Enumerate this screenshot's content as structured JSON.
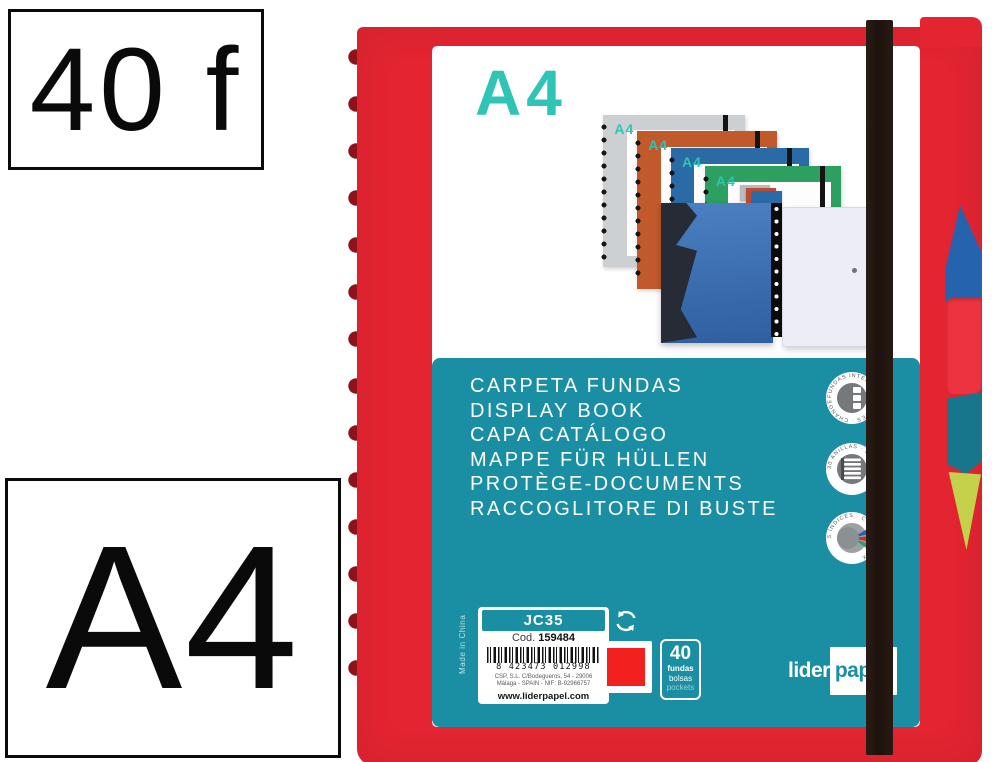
{
  "overlays": {
    "sheets": "40 f",
    "format": "A4"
  },
  "product": {
    "cover_format": "A4",
    "mini_cover_label": "A4",
    "banner_lines": [
      "CARPETA FUNDAS",
      "DISPLAY BOOK",
      "CAPA CATÁLOGO",
      "MAPPE FÜR HÜLLEN",
      "PROTÈGE-DOCUMENTS",
      "RACCOGLITORE DI BUSTE"
    ],
    "badges": [
      {
        "label": "FUNDAS INTERCAMBIABLES · CHANGEABLE POCKETS"
      },
      {
        "label": "30 ANILLAS · 30 RINGS"
      },
      {
        "label": "5 ÍNDICES · COLOR INDEX"
      }
    ],
    "info": {
      "model": "JC35",
      "code_label": "Cod.",
      "code": "159484",
      "barcode_digits": "8 423473 012998",
      "address_line1": "CSP, S.L. C/Bodegueros, 54 - 29006",
      "address_line2": "Málaga - SPAIN - NIF: B-92966757",
      "website": "www.liderpapel.com",
      "made_in": "Made in China",
      "quantity": {
        "value": "40",
        "unit_lines": [
          "fundas",
          "bolsas",
          "pockets"
        ]
      }
    },
    "brand": {
      "part1": "lider",
      "part2": "papel"
    }
  },
  "colors": {
    "red": "#E32431",
    "dark_red": "#8E1219",
    "teal": "#1A8EA2",
    "accent_teal": "#2EC4B6",
    "band_black": "#1D120D",
    "swatch_red": "#F32020",
    "tab_blue": "#2563AE",
    "tab_teal": "#17758C",
    "tab_yellow": "#C4D14B"
  }
}
